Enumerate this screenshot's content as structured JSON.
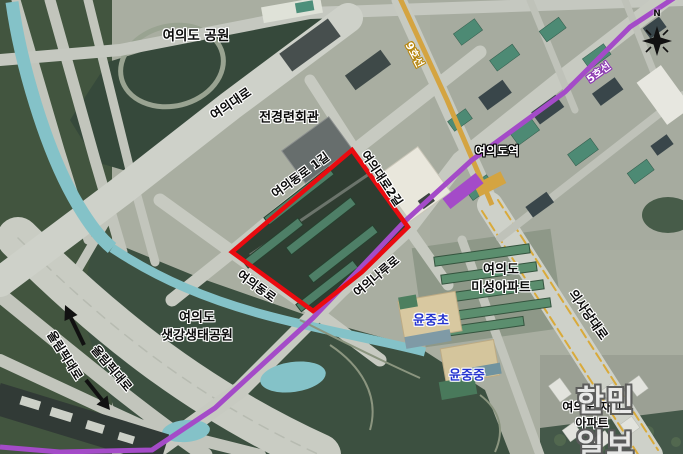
{
  "map": {
    "compass": {
      "north_label": "N"
    },
    "subway": {
      "line5": {
        "label": "5호선",
        "color": "#a44bc8"
      },
      "line9": {
        "label": "9호선",
        "color": "#d4a441"
      },
      "station": {
        "label": "여의도역"
      }
    },
    "places": {
      "park": "여의도 공원",
      "fki_hall": "전경련회관",
      "misung_apt": [
        "여의도",
        "미성아파트"
      ],
      "saetgang_park": [
        "여의도",
        "샛강생태공원"
      ],
      "xi_apt": [
        "여의도 자이",
        "아파트"
      ],
      "yunjung_elementary": "윤중초",
      "yunjung_middle": "윤중중"
    },
    "roads": {
      "yeouidaero": "여의대로",
      "yeouidongro_1gil": "여의동로 1길",
      "yeouidaero_2gil": "여의대로2길",
      "yeouidongro": "여의동로",
      "yeouinaruro": "여의나루로",
      "uisadang_daero": "의사당대로",
      "olympic_daero_a": "올림픽대로",
      "olympic_daero_b": "올림픽대로"
    },
    "colors": {
      "highlight_red": "#ea0b10",
      "line5_purple": "#a44bc8",
      "line9_gold": "#d4a441",
      "school_label_blue": "#2433cf",
      "stream_teal": "#86c5cb"
    },
    "watermark": "한민일보"
  }
}
